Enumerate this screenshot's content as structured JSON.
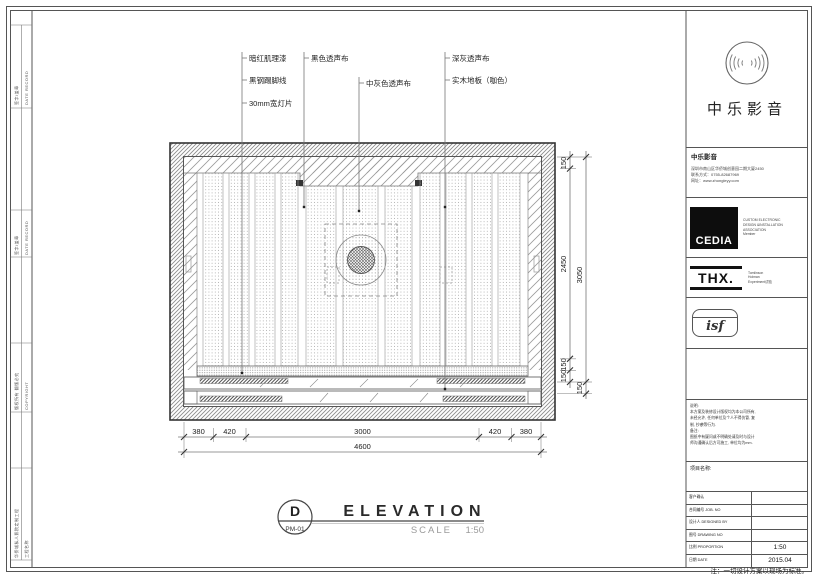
{
  "sheet": {
    "footnote": "注：一切设计方案以现场为标准。"
  },
  "callouts": {
    "paint": "暗红肌理漆",
    "skirting": "黑钢踢脚线",
    "lamp": "30mm宽灯片",
    "black_cloth": "黑色透声布",
    "gray_cloth": "中灰色透声布",
    "darkgray_cloth": "深灰透声布",
    "floor": "实木地板（咖色）"
  },
  "dims": {
    "bottom": [
      "380",
      "420",
      "3000",
      "420",
      "380"
    ],
    "bottom_total": "4600",
    "right_inner": [
      "150",
      "2450",
      "150",
      "150"
    ],
    "right_outer_total": "3050",
    "right_outer_seg": "150"
  },
  "title": {
    "letter": "D",
    "code": "PM-01",
    "name": "ELEVATION",
    "scale_label": "SCALE",
    "scale": "1:50"
  },
  "brand": {
    "name": "中乐影音"
  },
  "company": {
    "header": "中乐影音",
    "address": "深圳市南山区华侨城创意园二期大厦2450",
    "phone": "联系方式：0755-82687969",
    "web": "网址：www.zhongleyy.com"
  },
  "cedia": {
    "logo": "CEDIA",
    "line1": "CUSTOM ELECTRONIC",
    "line2": "DESIGN &INSTALLATION",
    "line3": "ASSOCIATION",
    "line4": "Member"
  },
  "thx": {
    "logo": "THX.",
    "line1": "Tomlinson",
    "line2": "Holman",
    "line3": "Experiment试验"
  },
  "isf": {
    "logo": "isf"
  },
  "notes": {
    "l1": "说明:",
    "l2": "本方案及装修设计版权均为本公司所有,",
    "l3": "未经允许, 任何单位及个人不得仿冒, 复",
    "l4": "制, 抄袭等行为.",
    "l5": "备注:",
    "l6": "图纸中有疑问或不明确处请及时与设计",
    "l7": "师沟通确认后方可施工, 单位均为mm."
  },
  "project": {
    "label": "项目名称:"
  },
  "table": {
    "rows": [
      {
        "label": "客户确认",
        "value": ""
      },
      {
        "label": "合同编号  JOB. NO",
        "value": ""
      },
      {
        "label": "设计人  DESIGNED BY",
        "value": ""
      },
      {
        "label": "图号  DRAWING NO",
        "value": ""
      },
      {
        "label": "比例  PROPORTION",
        "value": "1:50"
      },
      {
        "label": "日期  DATE",
        "value": "2015.04"
      }
    ]
  },
  "left_strip": {
    "seg1_zh": "签字/盖章",
    "seg1_en": "DATE RECORD",
    "seg2_zh": "签字/盖章",
    "seg2_en": "DATE RECORD",
    "seg3_zh": "版权所有 翻版必究",
    "seg3_en": "COPYRIGHT",
    "seg4_zh": "华侨城私人影院定制工程",
    "seg4_en": "工程名称"
  }
}
